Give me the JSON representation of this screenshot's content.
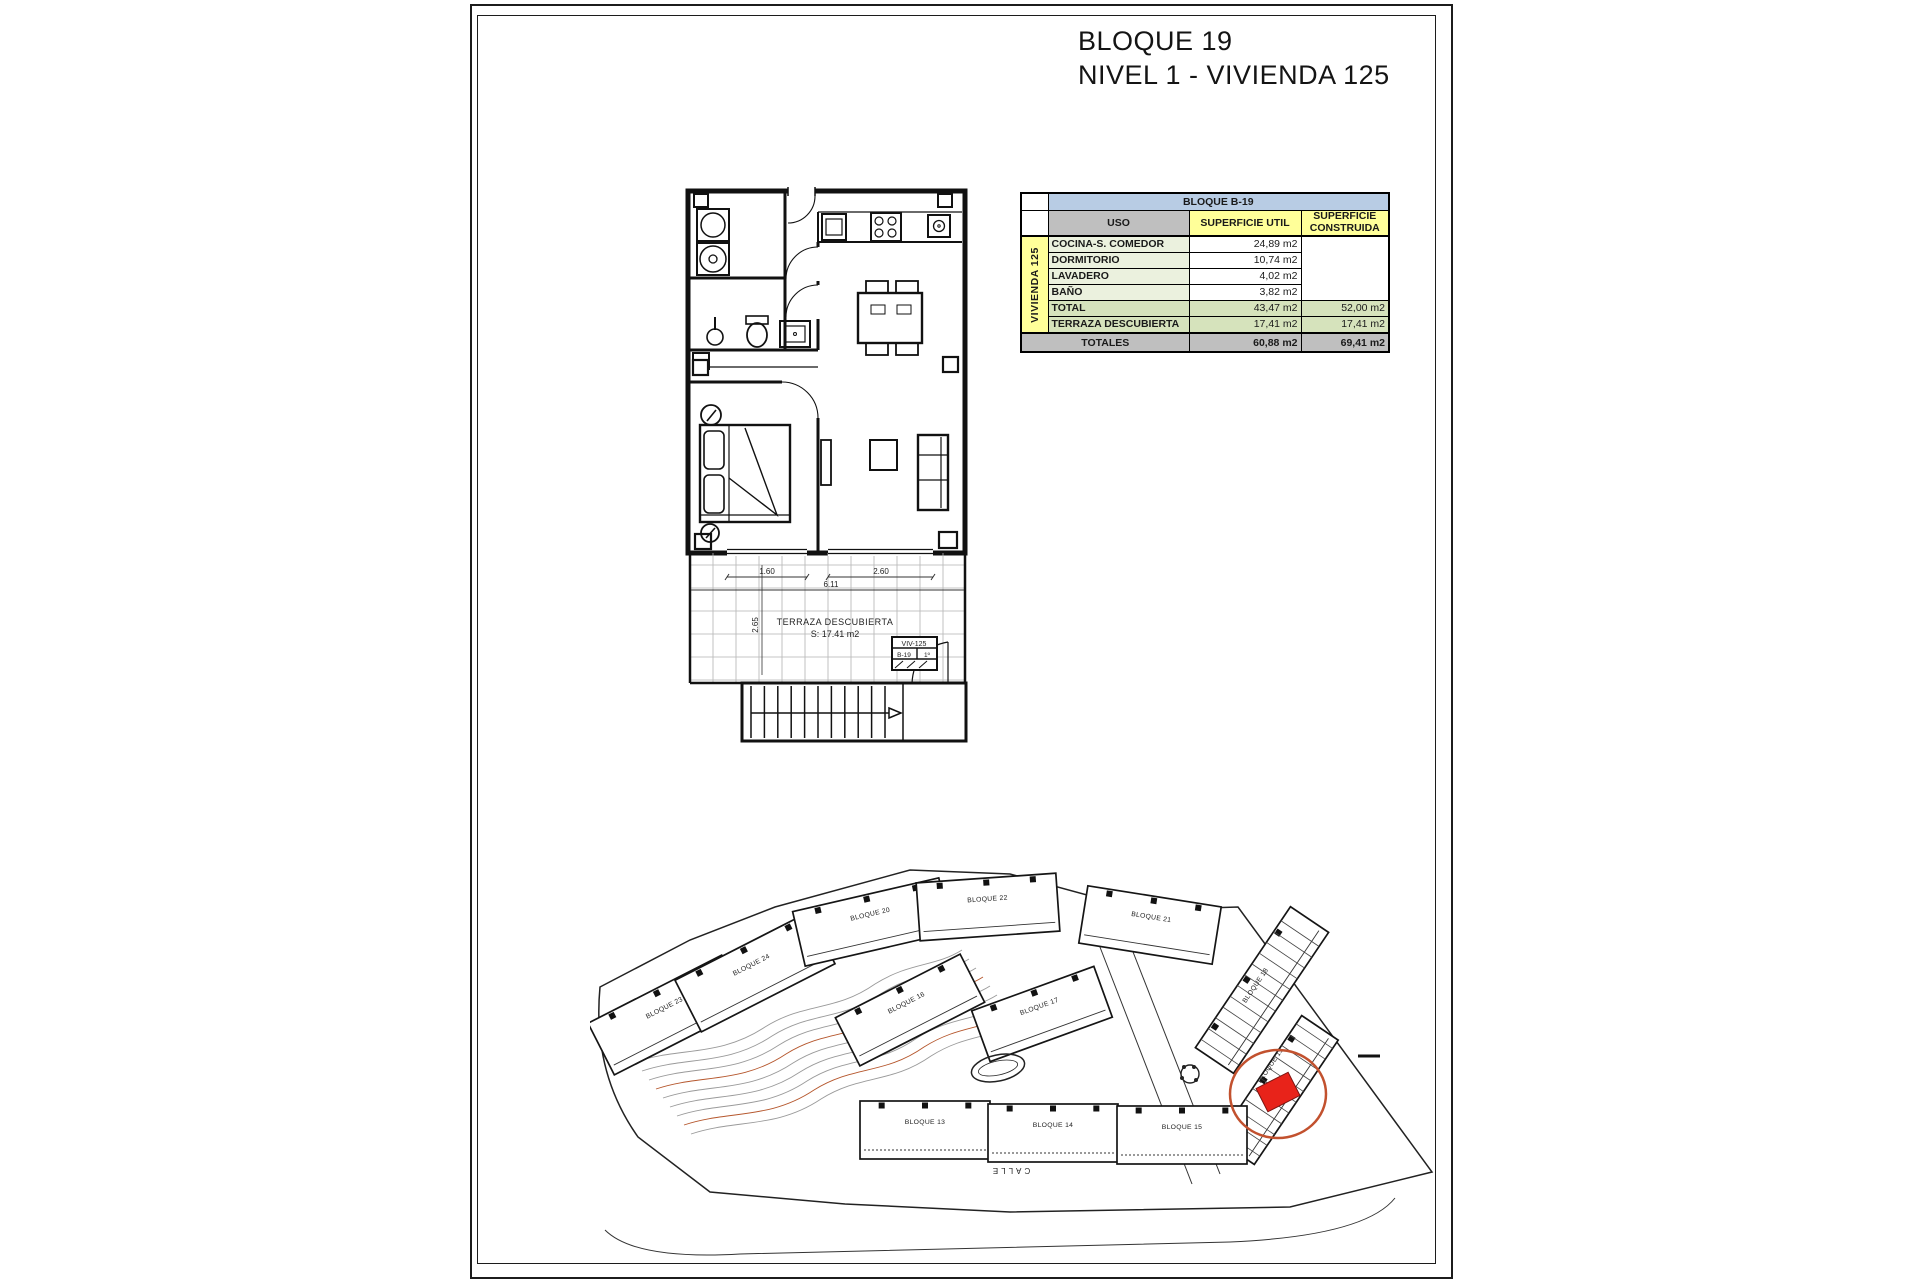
{
  "title": {
    "line1": "BLOQUE 19",
    "line2": "NIVEL 1 - VIVIENDA 125"
  },
  "table": {
    "block_header": "BLOQUE B-19",
    "row_label": "VIVIENDA 125",
    "col_headers": {
      "uso": "USO",
      "util": "SUPERFICIE UTIL",
      "construida": "SUPERFICIE CONSTRUIDA"
    },
    "rows": [
      {
        "uso": "COCINA-S. COMEDOR",
        "util": "24,89 m2"
      },
      {
        "uso": "DORMITORIO",
        "util": "10,74 m2"
      },
      {
        "uso": "LAVADERO",
        "util": "4,02 m2"
      },
      {
        "uso": "BAÑO",
        "util": "3,82 m2"
      }
    ],
    "total": {
      "uso": "TOTAL",
      "util": "43,47 m2",
      "construida": "52,00 m2"
    },
    "terraza": {
      "uso": "TERRAZA DESCUBIERTA",
      "util": "17,41 m2",
      "construida": "17,41 m2"
    },
    "totales": {
      "label": "TOTALES",
      "util": "60,88 m2",
      "construida": "69,41 m2"
    }
  },
  "floorplan": {
    "terrace_label": "TERRAZA DESCUBIERTA",
    "terrace_area": "S: 17.41 m2",
    "dim_left": "1.60",
    "dim_right": "2.60",
    "dim_total": "6.11",
    "dim_vertical": "2.65",
    "unit_tag": {
      "line1": "VIV-125",
      "line2a": "B-19",
      "line2b": "1º"
    }
  },
  "siteplan": {
    "street_label": "CALLE",
    "blocks": [
      {
        "label": "BLOQUE 23"
      },
      {
        "label": "BLOQUE 24"
      },
      {
        "label": "BLOQUE 20"
      },
      {
        "label": "BLOQUE 22"
      },
      {
        "label": "BLOQUE 21"
      },
      {
        "label": "BLOQUE 16"
      },
      {
        "label": "BLOQUE 17"
      },
      {
        "label": "BLOQUE 18"
      },
      {
        "label": "BLOQUE 19"
      },
      {
        "label": "BLOQUE 13"
      },
      {
        "label": "BLOQUE 14"
      },
      {
        "label": "BLOQUE 15"
      }
    ],
    "colors": {
      "highlight_block": "#e8231a",
      "highlight_circle": "#c2512e",
      "block_label": "#b03a30",
      "contour_gray": "#9a9a9a",
      "contour_orange": "#b5562c"
    }
  }
}
